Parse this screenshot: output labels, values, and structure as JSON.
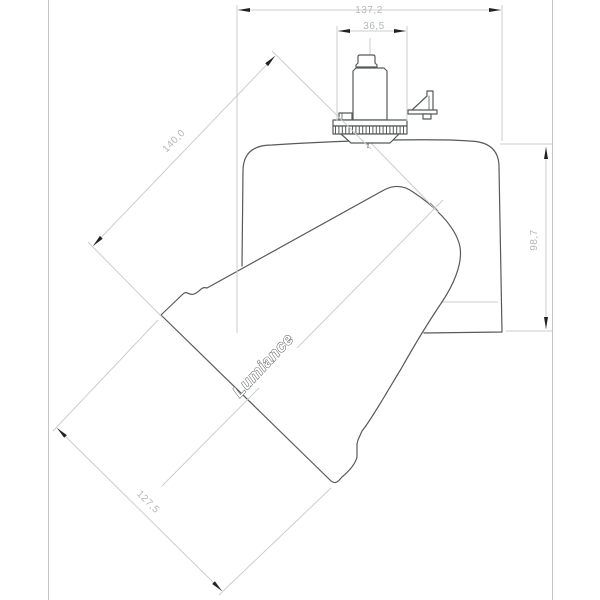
{
  "brand_label": "Lumiance",
  "dimensions": {
    "overall_width": "137,2",
    "adapter_width": "36,5",
    "arm_length": "140,0",
    "height": "98,7",
    "head_length": "127,5"
  },
  "colors": {
    "background": "#ffffff",
    "outline": "#565a5a",
    "dimension_lines": "#cbcecd",
    "dimension_text": "#b4b8b6",
    "arrowheads": "#222222"
  }
}
